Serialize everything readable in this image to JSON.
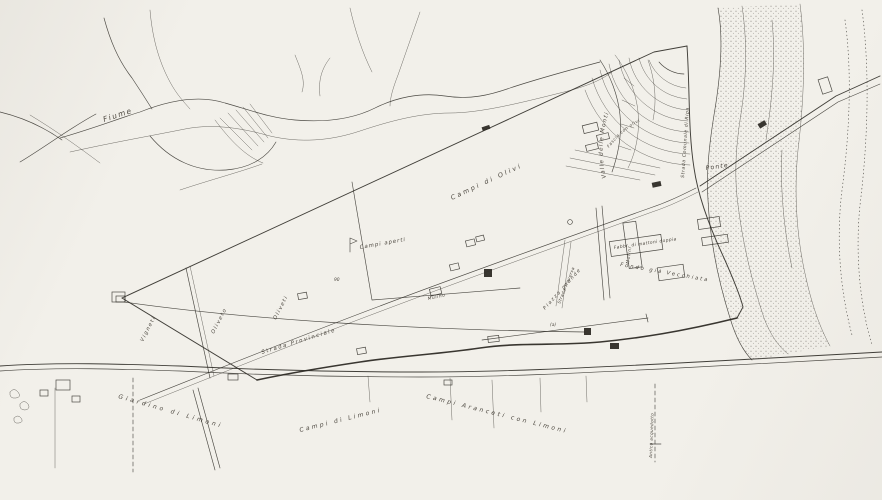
{
  "page": {
    "kind": "scanned hand-drawn estate survey map",
    "colors": {
      "paper": "#f2f0ea",
      "ink": "#2e2b26"
    }
  },
  "map": {
    "labels": [
      {
        "name": "fiume",
        "text": "Fiume"
      },
      {
        "name": "valle",
        "text": "Valle delle Monti"
      },
      {
        "name": "campi-di-olivi",
        "text": "Campi di Olivi"
      },
      {
        "name": "ponte",
        "text": "Ponte"
      },
      {
        "name": "strada-comunale",
        "text": "Strada Comunale di Ripa"
      },
      {
        "name": "campi-aperti",
        "text": "Campi aperti"
      },
      {
        "name": "strada-provinciale",
        "text": "Strada Provinciale"
      },
      {
        "name": "vigneti",
        "text": "Vigneti"
      },
      {
        "name": "oliveto",
        "text": "Oliveto"
      },
      {
        "name": "oliveti",
        "text": "Oliveti"
      },
      {
        "name": "giardino-di-limoni",
        "text": "Giardino di Limoni"
      },
      {
        "name": "campi-di-limoni",
        "text": "Campi di Limoni"
      },
      {
        "name": "campi-aranceti",
        "text": "Campi Aranceti con Limoni"
      },
      {
        "name": "fondo-vecchiata",
        "text": "Fondo già Vecchiata"
      },
      {
        "name": "fabbrica",
        "text": "Fabbr. di mattoni doppia"
      },
      {
        "name": "piazza-grande",
        "text": "Piazza grande"
      },
      {
        "name": "molini",
        "text": "Molini"
      },
      {
        "name": "strada-traversa",
        "text": "Strada Traversa"
      },
      {
        "name": "acquedotto",
        "text": "Antico acquedotto"
      },
      {
        "name": "fascia-olivi",
        "text": "Fascia con olivi"
      },
      {
        "name": "mulino",
        "text": "Mulino"
      },
      {
        "name": "marker-90",
        "text": "90"
      },
      {
        "name": "marker-a",
        "text": "(a)"
      }
    ]
  }
}
